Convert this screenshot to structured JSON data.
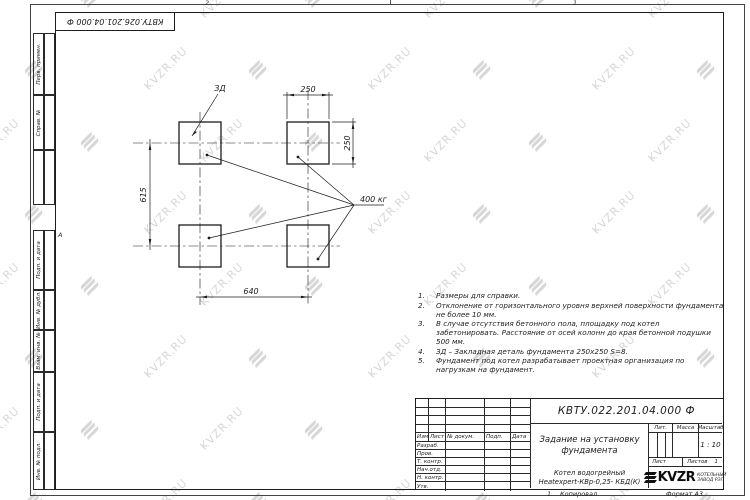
{
  "watermark": {
    "text": "KVZR.RU"
  },
  "frame": {
    "zone_top_left": "2",
    "zone_top_right": "1",
    "zone_left": "А"
  },
  "top_stamp": {
    "designation": "КВТУ.026.201.04.000 Ф"
  },
  "sidebar": {
    "cells": [
      {
        "label": "Перв. примен."
      },
      {
        "label": "Справ. №"
      },
      {
        "label": ""
      },
      {
        "label": "Подп. и дата"
      },
      {
        "label": "Инв. № дубл."
      },
      {
        "label": "Взам. инв. №"
      },
      {
        "label": "Подп. и дата"
      },
      {
        "label": "Инв. № подл."
      }
    ]
  },
  "drawing": {
    "detail_label": "ЗД",
    "load_label": "400 кг",
    "dim_width_top": "250",
    "dim_height_right": "250",
    "dim_vertical_left": "615",
    "dim_horizontal_bottom": "640"
  },
  "notes": {
    "items": [
      {
        "num": "1.",
        "text": "Размеры для справки."
      },
      {
        "num": "2.",
        "text": "Отклонение от горизонтального уровня верхней поверхности фундамента не более 10 мм."
      },
      {
        "num": "3.",
        "text": "В случае отсутствия бетонного пола, площадку под котел забетонировать. Расстояние от осей колонн до края бетонной подушки 500 мм."
      },
      {
        "num": "4.",
        "text": "ЗД – Закладная деталь фундамента 250х250 S=8."
      },
      {
        "num": "5.",
        "text": "Фундамент под котел разрабатывает проектная организация по нагрузкам на фундамент."
      }
    ]
  },
  "title_block": {
    "designation": "КВТУ.022.201.04.000 Ф",
    "doc_title": "Задание на установку фундамента",
    "product_line1": "Котел водогрейный",
    "product_line2": "Heatexpert-КВр-0,25- КБД(К)",
    "header": {
      "izm": "Изм",
      "list": "Лист",
      "docnum": "№ докум.",
      "sign": "Подп.",
      "date": "Дата"
    },
    "roles": [
      {
        "label": "Разраб."
      },
      {
        "label": "Пров."
      },
      {
        "label": "Т. контр."
      },
      {
        "label": "Нач.отд."
      },
      {
        "label": "Н. контр."
      },
      {
        "label": "Утв."
      }
    ],
    "lit_label": "Лит.",
    "mass_label": "Масса",
    "scale_label": "Масштаб",
    "scale_value": "1 : 10",
    "sheet_label": "Лист",
    "sheets_label": "Листов",
    "sheets_value": "1",
    "company": {
      "logo_text": "KVZR",
      "subtitle_line1": "КОТЕЛЬНЫЙ",
      "subtitle_line2": "ЗАВОД РЭП"
    }
  },
  "bottom_margin": {
    "left_num": "1",
    "copied_label": "Копировал",
    "format_label": "Формат А3"
  }
}
